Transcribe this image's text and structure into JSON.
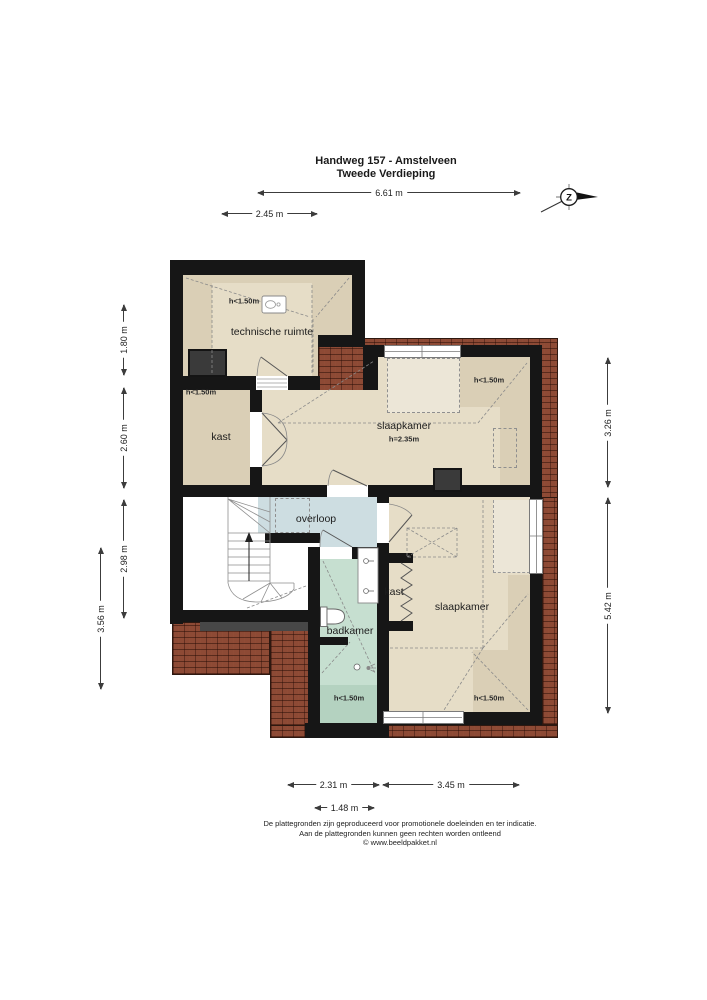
{
  "title": {
    "address": "Handweg 157 - Amstelveen",
    "floor": "Tweede Verdieping"
  },
  "compass": {
    "south_label": "Z"
  },
  "dimensions": {
    "top_total": "6.61 m",
    "top_left": "2.45 m",
    "left_upper": "1.80 m",
    "left_middle": "2.60 m",
    "left_lower": "2.98 m",
    "left_outer": "3.56 m",
    "right_upper": "3.26 m",
    "right_lower": "5.42 m",
    "bottom_left": "2.31 m",
    "bottom_right": "3.45 m",
    "bottom_inner": "1.48 m"
  },
  "rooms": {
    "technische_ruimte": {
      "label": "technische ruimte",
      "height_note": "h<1.50m"
    },
    "kast_boven": {
      "label": "kast",
      "height_note": "h<1.50m"
    },
    "slaapkamer_voor": {
      "label": "slaapkamer",
      "ceiling_height": "h=2.35m",
      "height_note": "h<1.50m"
    },
    "overloop": {
      "label": "overloop"
    },
    "badkamer": {
      "label": "badkamer",
      "height_note": "h<1.50m"
    },
    "kast_klein": {
      "label": "kast"
    },
    "slaapkamer_achter": {
      "label": "slaapkamer",
      "height_note": "h<1.50m"
    }
  },
  "footer": {
    "line1": "De plattegronden zijn geproduceerd voor promotionele doeleinden en ter indicatie.",
    "line2": "Aan de plattegronden kunnen geen rechten worden ontleend",
    "line3": "© www.beeldpakket.nl"
  },
  "colors": {
    "wall": "#161616",
    "floor": "#e6ddc7",
    "floor_low": "#dacfb6",
    "floor_light": "#ece6d7",
    "overloop": "#cddde1",
    "badkamer": "#c6dfd0",
    "roof_tiles": "#8d4a35"
  }
}
